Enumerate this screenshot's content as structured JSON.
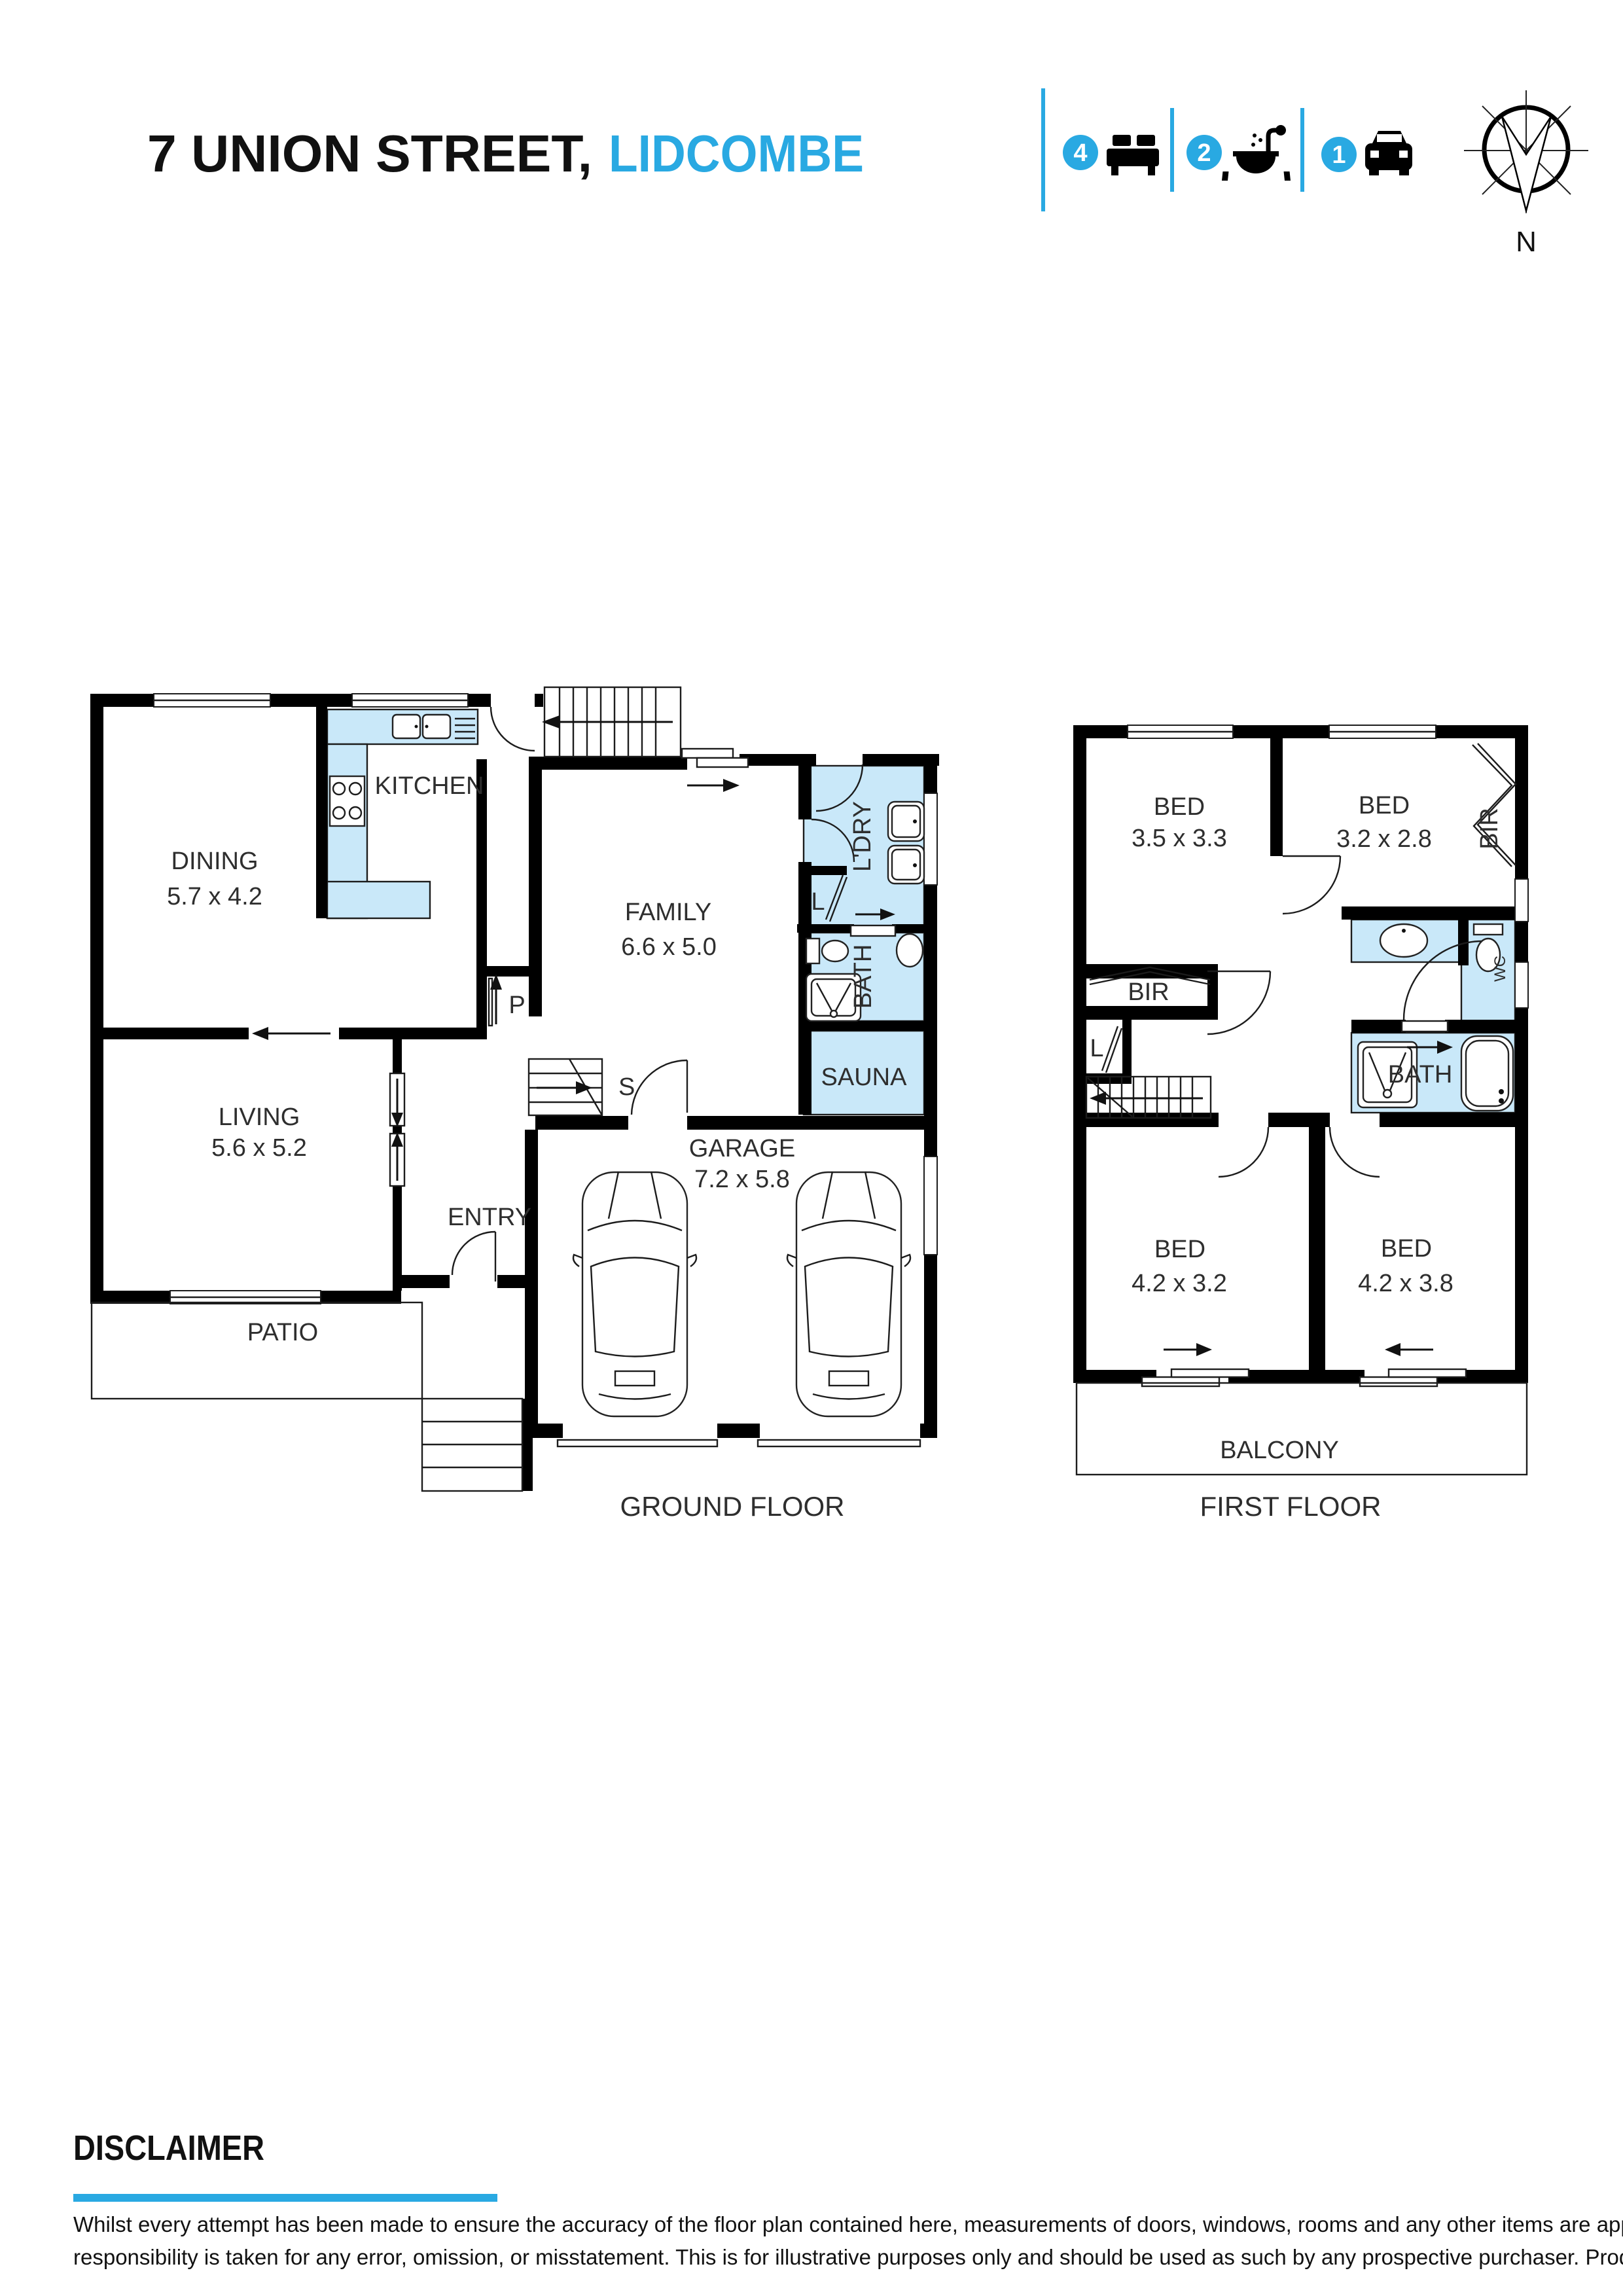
{
  "header": {
    "title_black": "7 UNION STREET,",
    "title_blue": "LIDCOMBE",
    "stats": [
      {
        "count": "4",
        "icon": "bed-icon"
      },
      {
        "count": "2",
        "icon": "bath-icon"
      },
      {
        "count": "1",
        "icon": "car-icon"
      }
    ],
    "compass": {
      "label": "N"
    }
  },
  "colors": {
    "accent": "#29A9E2",
    "wet_area": "#C9E8F9",
    "wall": "#000000"
  },
  "ground_floor": {
    "caption": "GROUND FLOOR",
    "rooms": {
      "dining": {
        "name": "DINING",
        "dims": "5.7 x 4.2"
      },
      "kitchen": {
        "name": "KITCHEN"
      },
      "pantry": {
        "name": "P"
      },
      "family": {
        "name": "FAMILY",
        "dims": "6.6 x 5.0"
      },
      "laundry": {
        "name": "L'DRY"
      },
      "linen": {
        "name": "L"
      },
      "bath": {
        "name": "BATH"
      },
      "sauna": {
        "name": "SAUNA"
      },
      "stairs": {
        "name": "S"
      },
      "living": {
        "name": "LIVING",
        "dims": "5.6 x 5.2"
      },
      "entry": {
        "name": "ENTRY"
      },
      "garage": {
        "name": "GARAGE",
        "dims": "7.2 x 5.8"
      },
      "patio": {
        "name": "PATIO"
      }
    }
  },
  "first_floor": {
    "caption": "FIRST FLOOR",
    "rooms": {
      "bed1": {
        "name": "BED",
        "dims": "3.5 x 3.3"
      },
      "bed2": {
        "name": "BED",
        "dims": "3.2 x 2.8"
      },
      "bir1": {
        "name": "BIR"
      },
      "bir2": {
        "name": "BIR"
      },
      "linen": {
        "name": "L"
      },
      "wc": {
        "name": "WC"
      },
      "bath": {
        "name": "BATH"
      },
      "bed3": {
        "name": "BED",
        "dims": "4.2 x 3.2"
      },
      "bed4": {
        "name": "BED",
        "dims": "4.2 x 3.8"
      },
      "balcony": {
        "name": "BALCONY"
      }
    }
  },
  "disclaimer": {
    "heading": "DISCLAIMER",
    "lines": [
      "Whilst every attempt  has been made to ensure the accuracy of the floor plan contained here, measurements of doors, windows, rooms and any other items are approximate and no",
      "responsibility is taken for any error, omission, or misstatement. This is for illustrative purposes only and should be used as such by any prospective purchaser. Produced by VIBEO"
    ]
  }
}
